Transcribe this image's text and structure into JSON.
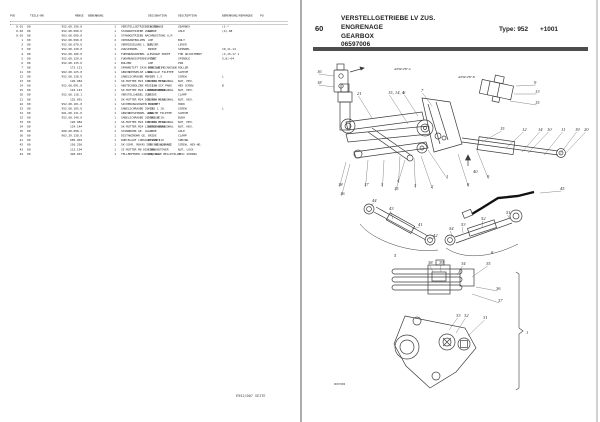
{
  "left_page": {
    "header_cols": [
      "POS",
      "TEILE-NR",
      "MENGE",
      "BENENNUNG",
      "DESIGNATION",
      "DESCRIPTION",
      "BEMERKUNG/REMARQUE",
      "PU"
    ],
    "table": {
      "rows": [
        [
          "0.01",
          "00",
          "952.68.190.0",
          "1",
          "VERSTELLGETRIEBE L ZUS.",
          "ENGRENAGE",
          "GEARBOX",
          "(1-*",
          ""
        ],
        [
          "0.02",
          "00",
          "952.68.090.0",
          "1",
          "STANDGETRIEBE ZUS.",
          "ARBRE",
          "AXLE",
          "(4)-68",
          ""
        ],
        [
          "0.03",
          "00",
          "963.68.090.0",
          "1",
          "STANDGETRIEBE NACHRUESTUNG U,M",
          "",
          "",
          "",
          ""
        ],
        [
          "1",
          "00",
          "952.68.090.0",
          "2",
          "VIERKANTBOLZEN",
          "AXE",
          "BOLT",
          "",
          ""
        ],
        [
          "2",
          "00",
          "952.68.070.0",
          "1",
          "VERRIEGELUNG L ZUS.",
          "LEVIER",
          "LEVER",
          "",
          ""
        ],
        [
          "3",
          "00",
          "952.68.130.0",
          "1",
          "ZUGSPINDEL",
          "BRIDE",
          "SPINDEL",
          "10,11-14",
          ""
        ],
        [
          "4",
          "00",
          "952.68.100.0",
          "1",
          "FUEHRUNGSHEBEL L",
          "LEVRAGE PORTE",
          "FOR ADJUSTMENT",
          "(4,15-17 1",
          ""
        ],
        [
          "5",
          "00",
          "952.68.120.0",
          "1",
          "FUEHRUNGSSPINDEL ZUS.",
          "PIVOT",
          "SPINDLE",
          "5,8)-04",
          ""
        ],
        [
          "6",
          "00",
          "952.68.135.0",
          "1",
          "BOLZEN",
          "AXE",
          "PIN",
          "",
          ""
        ],
        [
          "7",
          "00",
          "172.121",
          "6",
          "SPANNSTIFT 5X36 DIN 1481",
          "DOUILLE MECANIQUE",
          "ROLLER",
          "",
          ""
        ],
        [
          "11",
          "00",
          "962.68.125.0",
          "1",
          "GEWINDEHUELSE LANG",
          "DOUILLE FILETEE",
          "SLEEVE",
          "",
          ""
        ],
        [
          "12",
          "00",
          "952.68.138.0",
          "1",
          "GABELSCHRAUBE M8-170 1.5",
          "VIS",
          "SCREW",
          "L",
          ""
        ],
        [
          "13",
          "00",
          "120.984",
          "1",
          "SK-MUTTER M24 DIN 934 M 10",
          "ECROU HEXAGONAL",
          "NUT, HEX.",
          "",
          ""
        ],
        [
          "14",
          "00",
          "952.68.091.0",
          "1",
          "ABSTECKBOLZEN MI. 180",
          "VIS A SIX PANS",
          "HEX SCREW",
          "B",
          ""
        ],
        [
          "15",
          "00",
          "124.143",
          "1",
          "SK-MUTTER M24 LINKSGEWINDE",
          "ECROU HEXAGONAL",
          "NUT, HEX.",
          "",
          ""
        ],
        [
          "16",
          "00",
          "952.68.118.1",
          "1",
          "VERSTELLHEBEL ZUS.",
          "BRIDE",
          "CLAMP",
          "",
          ""
        ],
        [
          "21",
          "00",
          "125.091",
          "1",
          "SK-MUTTER M24 DIN 934 M 10",
          "ECROU HEXAGONAL",
          "NUT, HEX.",
          "",
          ""
        ],
        [
          "22",
          "00",
          "952.68.101.0",
          "1",
          "SICHERUNGSHAKEN M 100",
          "CROCHET",
          "HOOK",
          "",
          ""
        ],
        [
          "23",
          "00",
          "952.68.105.0",
          "1",
          "GABELSCHRAUBE 20-165 1 10.",
          "VIS",
          "SCREW",
          "L",
          ""
        ],
        [
          "31",
          "00",
          "961.68.131.0",
          "1",
          "GEWINDESPINDEL LANG",
          "BROCHE FILETEE",
          "SLEEVE",
          "",
          ""
        ],
        [
          "32",
          "00",
          "952.68.140.0",
          "1",
          "GABELSCHRAUBE 20-165 M 10.",
          "DOUILLE",
          "BUSH",
          "",
          ""
        ],
        [
          "33",
          "00",
          "120.984",
          "1",
          "SK-MUTTER M24 DIN 934 M 10",
          "ECROU HEXAGONAL",
          "NUT, HEX.",
          "",
          ""
        ],
        [
          "34",
          "00",
          "124.144",
          "1",
          "SK-MUTTER M24 LINKSGEWINDE",
          "ECROU HEXAGONAL",
          "NUT, HEX.",
          "",
          ""
        ],
        [
          "35",
          "00",
          "960.68.098.1",
          "1",
          "STANDROHR GE. UL",
          "ARBRE",
          "AXLE",
          "",
          ""
        ],
        [
          "36",
          "00",
          "963.29.138.0",
          "1",
          "DISTANZROHR GE.",
          "BRIDE",
          "CLAMP",
          "",
          ""
        ],
        [
          "41",
          "00",
          "685.903",
          "1",
          "RUECKLAUF CONSOLE DIN 119",
          "RESSORT",
          "SPRING",
          "",
          ""
        ],
        [
          "42",
          "00",
          "103.256",
          "1",
          "SK-SCHR. M8X45 DIN 931 8,8 VZ",
          "VIS HEXAGONALE",
          "SCREW, HEX-HD.",
          "",
          ""
        ],
        [
          "43",
          "00",
          "112.194",
          "1",
          "SI-MUTTER M8 DIN 980-6",
          "ECROU STOVER",
          "NUT, LOCK",
          "",
          ""
        ],
        [
          "44",
          "00",
          "420.653",
          "1",
          "TELLERFEDER C40X20, 4X1",
          "RONDELLE BELLEVILLE",
          "DISC SPRING",
          "",
          ""
        ]
      ]
    },
    "footer": "E952/007 SEITE"
  },
  "right_page": {
    "section_no": "60",
    "title_lines": [
      "VERSTELLGETRIEBE LV ZUS.",
      "ENGRENAGE",
      "GEARBOX",
      "06597006"
    ],
    "type_label": "Type: 952",
    "serial_label": "+1001",
    "diagram": {
      "caption": "06597006",
      "view_labels": [
        {
          "t": "ANSICHT A",
          "x": 84,
          "y": 14
        },
        {
          "t": "ANSICHT B",
          "x": 148,
          "y": 22
        }
      ],
      "callouts": [
        {
          "t": "16",
          "x": 7,
          "y": 17,
          "lx": 24,
          "ly": 20
        },
        {
          "t": "18",
          "x": 7,
          "y": 28,
          "lx": 24,
          "ly": 31
        },
        {
          "t": "9",
          "x": 224,
          "y": 28,
          "lx": 206,
          "ly": 30
        },
        {
          "t": "13",
          "x": 225,
          "y": 37,
          "lx": 204,
          "ly": 38
        },
        {
          "t": "15",
          "x": 225,
          "y": 48,
          "lx": 200,
          "ly": 45
        },
        {
          "t": "21",
          "x": 47,
          "y": 39,
          "lx": 62,
          "ly": 62
        },
        {
          "t": "15, 14, 4",
          "x": 78,
          "y": 38,
          "lx": 98,
          "ly": 68
        },
        {
          "t": "6",
          "x": 93,
          "y": 38,
          "lx": 108,
          "ly": 60
        },
        {
          "t": "7",
          "x": 111,
          "y": 36,
          "lx": 122,
          "ly": 50
        },
        {
          "t": "15",
          "x": 190,
          "y": 74,
          "lx": 172,
          "ly": 86
        },
        {
          "t": "12",
          "x": 212,
          "y": 75,
          "lx": 196,
          "ly": 92
        },
        {
          "t": "14",
          "x": 228,
          "y": 75,
          "lx": 212,
          "ly": 96
        },
        {
          "t": "10",
          "x": 237,
          "y": 75,
          "lx": 218,
          "ly": 97
        },
        {
          "t": "11",
          "x": 251,
          "y": 75,
          "lx": 234,
          "ly": 99
        },
        {
          "t": "19",
          "x": 265,
          "y": 75,
          "lx": 250,
          "ly": 98
        },
        {
          "t": "20",
          "x": 274,
          "y": 75,
          "lx": 254,
          "ly": 99
        },
        {
          "t": "18",
          "x": 28,
          "y": 130,
          "lx": 36,
          "ly": 106
        },
        {
          "t": "16",
          "x": 30,
          "y": 139,
          "lx": 40,
          "ly": 108
        },
        {
          "t": "17",
          "x": 54,
          "y": 130,
          "lx": 58,
          "ly": 104
        },
        {
          "t": "5",
          "x": 71,
          "y": 130,
          "lx": 74,
          "ly": 104
        },
        {
          "t": "4",
          "x": 87,
          "y": 126,
          "lx": 90,
          "ly": 100
        },
        {
          "t": "15",
          "x": 84,
          "y": 134,
          "lx": 95,
          "ly": 104
        },
        {
          "t": "3",
          "x": 104,
          "y": 131,
          "lx": 104,
          "ly": 102
        },
        {
          "t": "2",
          "x": 121,
          "y": 132,
          "lx": 111,
          "ly": 100
        },
        {
          "t": "1",
          "x": 136,
          "y": 122,
          "lx": 118,
          "ly": 94
        },
        {
          "t": "8",
          "x": 157,
          "y": 130,
          "lx": 148,
          "ly": 98
        },
        {
          "t": "9",
          "x": 177,
          "y": 122,
          "lx": 166,
          "ly": 92
        },
        {
          "t": "40",
          "x": 163,
          "y": 117
        },
        {
          "t": "45",
          "x": 250,
          "y": 134,
          "lx": 230,
          "ly": 137
        },
        {
          "t": "44",
          "x": 62,
          "y": 146,
          "lx": 60,
          "ly": 151
        },
        {
          "t": "43",
          "x": 79,
          "y": 154,
          "lx": 83,
          "ly": 163
        },
        {
          "t": "41",
          "x": 108,
          "y": 170,
          "lx": 102,
          "ly": 173
        },
        {
          "t": "42",
          "x": 123,
          "y": 181,
          "lx": 119,
          "ly": 183
        },
        {
          "t": "5",
          "x": 84,
          "y": 201
        },
        {
          "t": "54",
          "x": 139,
          "y": 174,
          "lx": 142,
          "ly": 181
        },
        {
          "t": "53",
          "x": 151,
          "y": 170,
          "lx": 153,
          "ly": 177
        },
        {
          "t": "52",
          "x": 171,
          "y": 164,
          "lx": 172,
          "ly": 171
        },
        {
          "t": "51",
          "x": 196,
          "y": 158,
          "lx": 200,
          "ly": 163
        },
        {
          "t": "8",
          "x": 181,
          "y": 198
        },
        {
          "t": "38",
          "x": 118,
          "y": 208,
          "lx": 123,
          "ly": 216
        },
        {
          "t": "39",
          "x": 129,
          "y": 208,
          "lx": 131,
          "ly": 216
        },
        {
          "t": "34",
          "x": 151,
          "y": 209,
          "lx": 147,
          "ly": 219
        },
        {
          "t": "35",
          "x": 176,
          "y": 209,
          "lx": 162,
          "ly": 221
        },
        {
          "t": "36",
          "x": 186,
          "y": 234,
          "lx": 166,
          "ly": 231
        },
        {
          "t": "37",
          "x": 188,
          "y": 246,
          "lx": 162,
          "ly": 238
        },
        {
          "t": "33",
          "x": 146,
          "y": 261,
          "lx": 139,
          "ly": 274
        },
        {
          "t": "32",
          "x": 154,
          "y": 261,
          "lx": 146,
          "ly": 277
        },
        {
          "t": "31",
          "x": 173,
          "y": 263,
          "lx": 158,
          "ly": 280
        },
        {
          "t": "1",
          "x": 216,
          "y": 278
        }
      ]
    }
  }
}
